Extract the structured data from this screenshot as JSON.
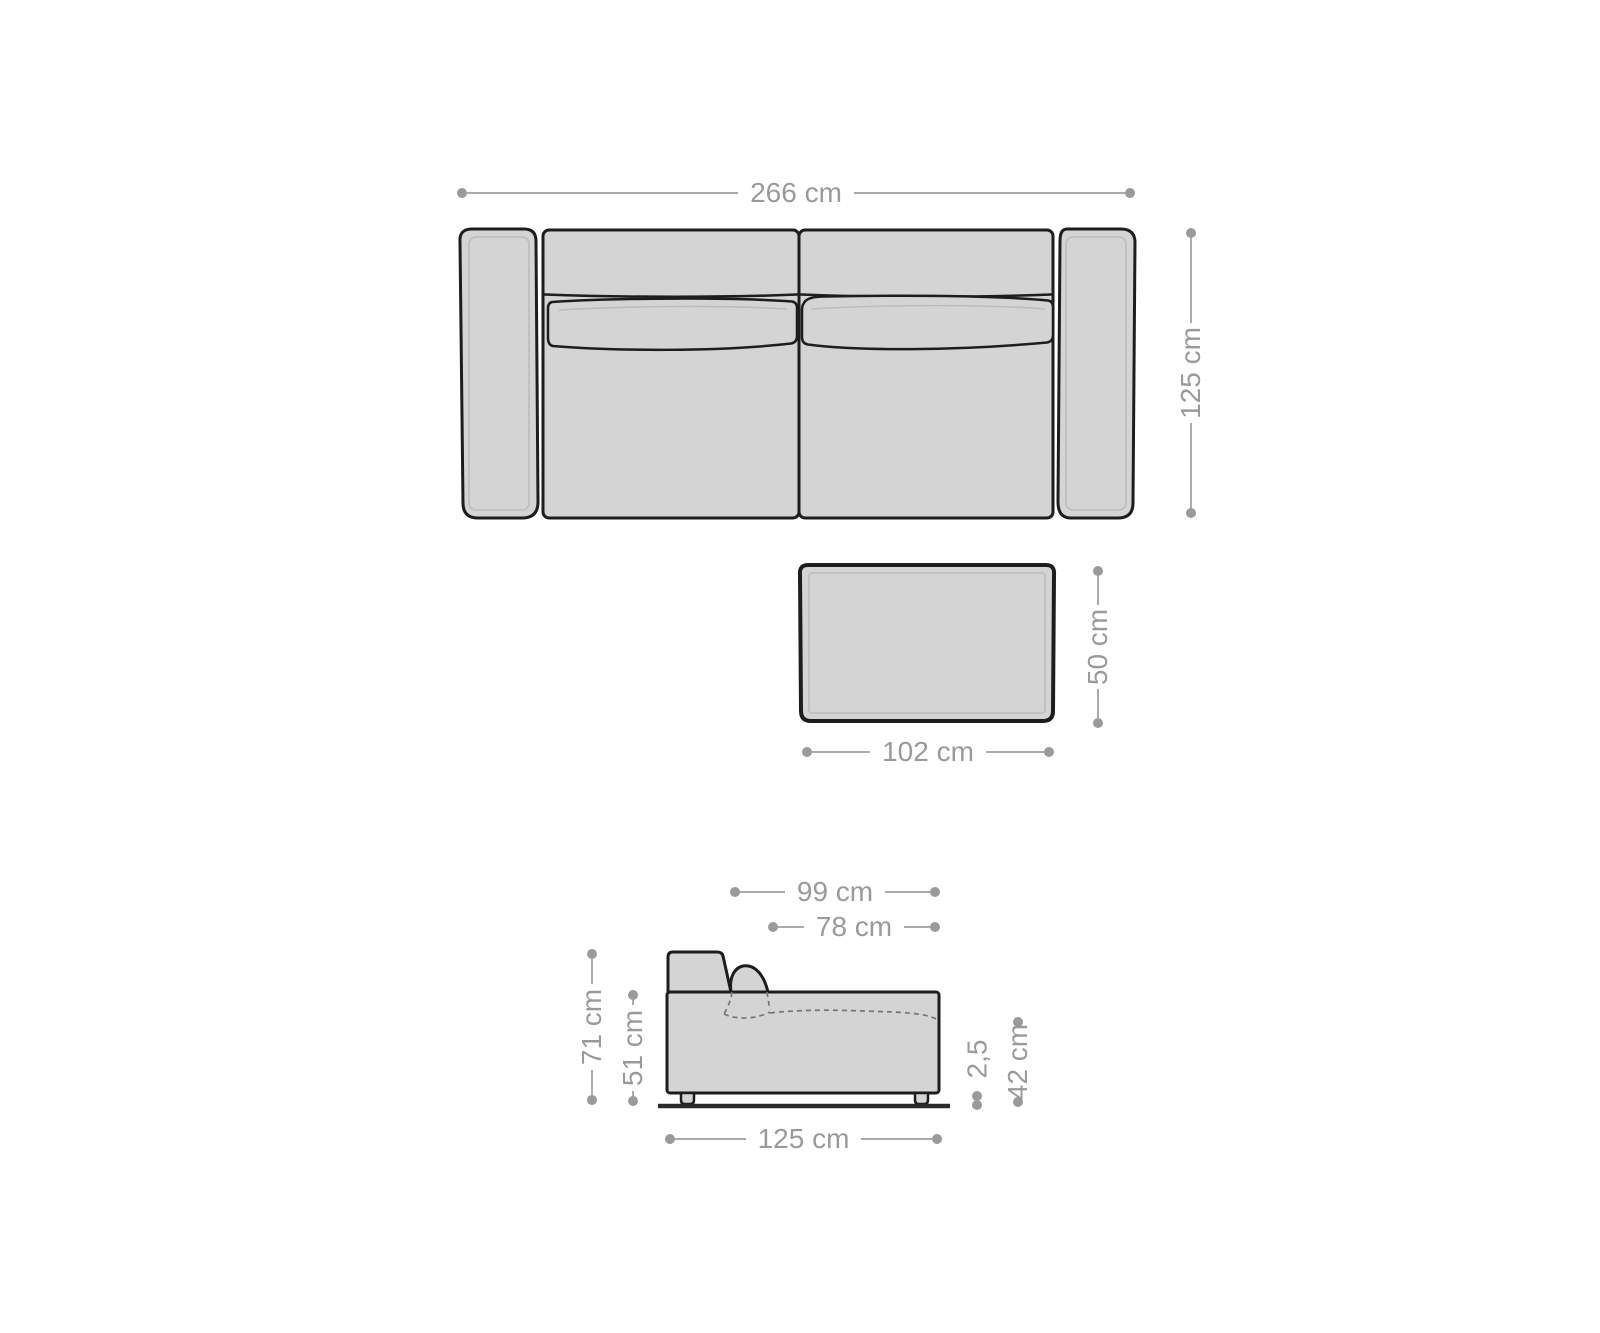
{
  "colors": {
    "background": "#ffffff",
    "dimension_gray": "#9a9a9a",
    "dimension_line": "#ababab",
    "furniture_outline": "#1d1d1d",
    "furniture_fill": "#d4d4d4",
    "floor_line": "#2a2a2a",
    "highlight_line": "#bcbcbc"
  },
  "sofa_top_view": {
    "width": "266 cm",
    "depth": "125 cm"
  },
  "coffee_table_top_view": {
    "width": "102 cm",
    "depth": "50 cm"
  },
  "sofa_side_view": {
    "depth_with_backrest": "99 cm",
    "seat_depth": "78 cm",
    "total_height": "71 cm",
    "armrest_height": "51 cm",
    "leg_height": "2,5",
    "seat_height": "42 cm",
    "total_depth": "125 cm"
  }
}
